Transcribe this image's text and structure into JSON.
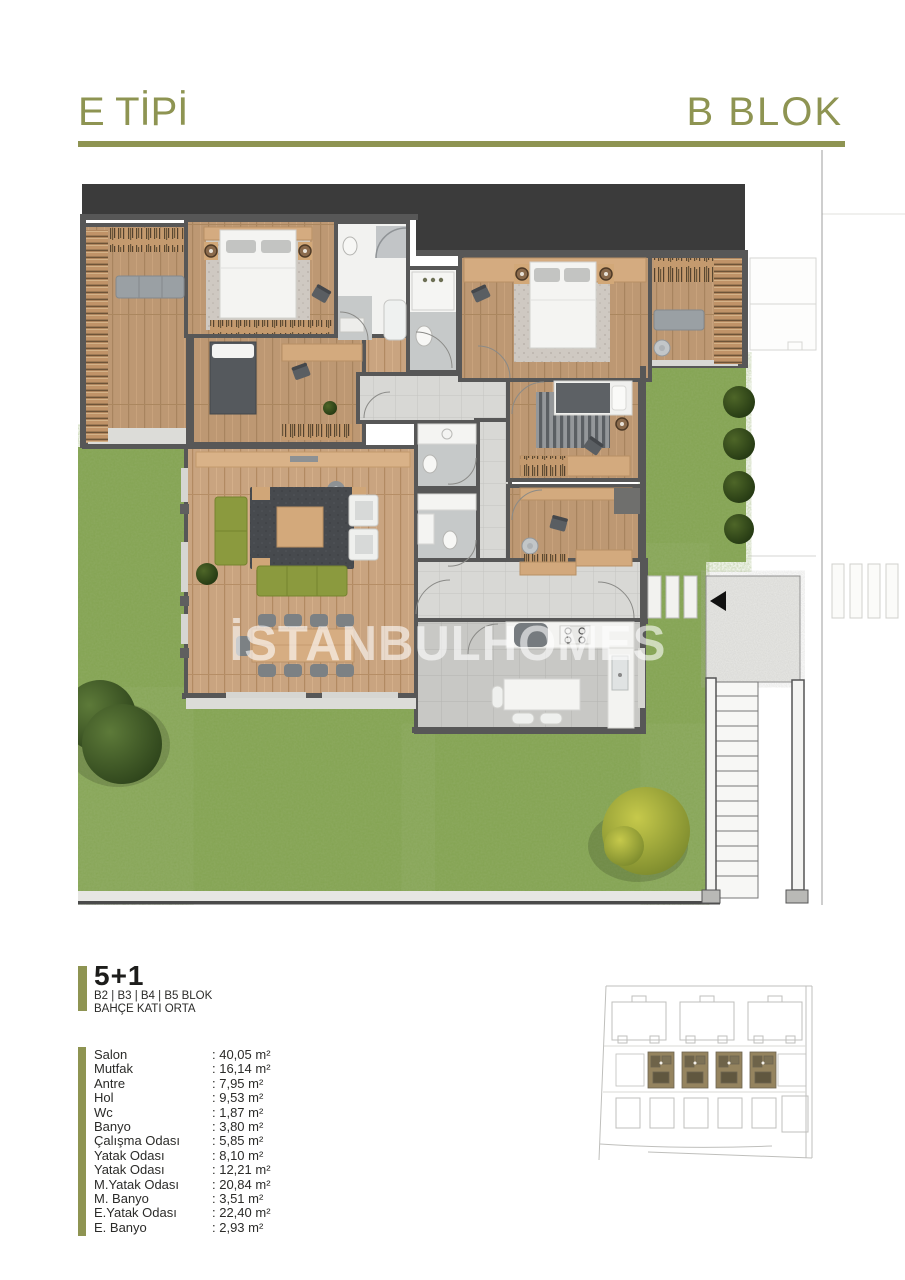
{
  "header": {
    "type_label": "E TİPİ",
    "block_label": "B BLOK"
  },
  "watermark": "İSTANBULHOMES",
  "unit": {
    "plan_label": "5+1",
    "blocks_label": "B2 | B3 | B4 | B5 BLOK",
    "floor_label": "BAHÇE KATI ORTA"
  },
  "rooms": [
    {
      "name": "Salon",
      "area": ": 40,05 m²"
    },
    {
      "name": "Mutfak",
      "area": ": 16,14 m²"
    },
    {
      "name": "Antre",
      "area": ": 7,95 m²"
    },
    {
      "name": "Hol",
      "area": ": 9,53 m²"
    },
    {
      "name": "Wc",
      "area": ": 1,87 m²"
    },
    {
      "name": "Banyo",
      "area": ": 3,80 m²"
    },
    {
      "name": "Çalışma Odası",
      "area": ": 5,85 m²"
    },
    {
      "name": "Yatak Odası",
      "area": ": 8,10 m²"
    },
    {
      "name": "Yatak Odası",
      "area": ": 12,21 m²"
    },
    {
      "name": "M.Yatak Odası",
      "area": ": 20,84 m²"
    },
    {
      "name": "M. Banyo",
      "area": ": 3,51 m²"
    },
    {
      "name": "E.Yatak Odası",
      "area": ": 22,40 m²"
    },
    {
      "name": "E. Banyo",
      "area": ": 2,93 m²"
    }
  ],
  "palette": {
    "accent": "#8e9452",
    "roof": "#3b3b3b",
    "wall": "#575757",
    "grass": "#83a351",
    "wood": "#bd9873",
    "site_highlight": "#95845f"
  }
}
